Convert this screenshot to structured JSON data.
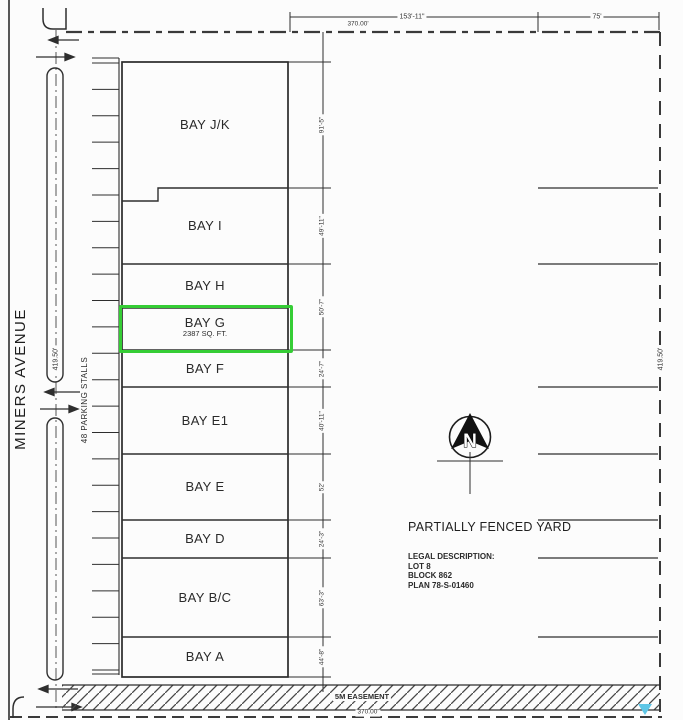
{
  "plan": {
    "street": {
      "name": "MINERS AVENUE",
      "west_depth": "419.50'",
      "east_depth": "419.50'"
    },
    "parking": {
      "label": "48 PARKING STALLS",
      "stall_count": 24
    },
    "dimensions": {
      "top_overall": "370.00'",
      "top_left_span": "153'-11\"",
      "top_right_span": "75'",
      "bottom_overall": "370.00'"
    },
    "easement": {
      "label": "5M EASEMENT"
    },
    "yard": {
      "label": "PARTIALLY FENCED YARD",
      "legal_title": "LEGAL DESCRIPTION:",
      "legal_lines": [
        "LOT 8",
        "BLOCK 862",
        "PLAN 78-S-01460"
      ],
      "fence_line_ys": [
        188,
        264,
        387,
        454,
        520,
        558,
        637
      ]
    },
    "north_arrow_label": "N",
    "building": {
      "bays": [
        {
          "name": "BAY J/K",
          "top": 62,
          "bottom": 188,
          "jogged_bottom": true
        },
        {
          "name": "BAY I",
          "top": 188,
          "bottom": 264
        },
        {
          "name": "BAY H",
          "top": 264,
          "bottom": 308
        },
        {
          "name": "BAY G",
          "area": "2387 SQ. FT.",
          "top": 308,
          "bottom": 350,
          "highlighted": true
        },
        {
          "name": "BAY F",
          "top": 350,
          "bottom": 387
        },
        {
          "name": "BAY E1",
          "top": 387,
          "bottom": 454
        },
        {
          "name": "BAY E",
          "top": 454,
          "bottom": 520
        },
        {
          "name": "BAY D",
          "top": 520,
          "bottom": 558
        },
        {
          "name": "BAY B/C",
          "top": 558,
          "bottom": 637
        },
        {
          "name": "BAY A",
          "top": 637,
          "bottom": 677
        }
      ],
      "side_dimensions": [
        {
          "label": "91'-5\"",
          "top": 62,
          "bottom": 188
        },
        {
          "label": "49'-11\"",
          "top": 188,
          "bottom": 264
        },
        {
          "label": "50'-7\"",
          "top": 264,
          "bottom": 350
        },
        {
          "label": "24'-7\"",
          "top": 350,
          "bottom": 387
        },
        {
          "label": "40'-11\"",
          "top": 387,
          "bottom": 454
        },
        {
          "label": "52'",
          "top": 454,
          "bottom": 520
        },
        {
          "label": "24'-3\"",
          "top": 520,
          "bottom": 558
        },
        {
          "label": "63'-3\"",
          "top": 558,
          "bottom": 637
        },
        {
          "label": "44'-8\"",
          "top": 637,
          "bottom": 677
        }
      ]
    },
    "colors": {
      "highlight": "#35cd35",
      "marker": "#5ec6e6"
    }
  }
}
